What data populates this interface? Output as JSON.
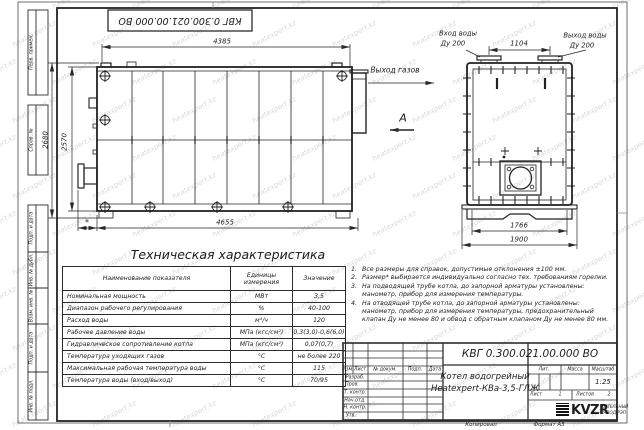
{
  "watermark": "heatexpert.kz",
  "frame": {
    "top_doc_box": "КВГ 0.300.021.00.000 ВО",
    "side_labels": [
      "Перв. примен.",
      "Справ. №",
      "Подп. и дата",
      "Инв. № дубл.",
      "Взам. инв. №",
      "Подп. и дата",
      "Инв. № подл."
    ],
    "footer_copied": "Копировал",
    "footer_format": "Формат А3"
  },
  "side_view": {
    "dim_top": "4385",
    "dim_bottom": "4655",
    "dim_height_outer": "2680",
    "dim_height_inner": "2570",
    "dim_burner": "*",
    "gas_outlet": "Выход газов",
    "view_label": "А"
  },
  "top_view": {
    "inlet_line1": "Вход воды",
    "inlet_line2": "Ду 200",
    "outlet_line1": "Выход воды",
    "outlet_line2": "Ду 200",
    "dim_nozzles": "1104",
    "dim_inner": "1766",
    "dim_outer": "1900"
  },
  "spec": {
    "title": "Техническая характеристика",
    "headers": {
      "name": "Наименование показателя",
      "unit": "Единицы измерения",
      "value": "Значение"
    },
    "rows": [
      {
        "name": "Номинальная мощность",
        "unit": "МВт",
        "value": "3,5"
      },
      {
        "name": "Диапазон рабочего регулирования",
        "unit": "%",
        "value": "40-100"
      },
      {
        "name": "Расход воды",
        "unit": "м³/ч",
        "value": "120"
      },
      {
        "name": "Рабочее давление воды",
        "unit": "МПа (кгс/см²)",
        "value": "0,3(3,0)-0,6(6,0)"
      },
      {
        "name": "Гидравлическое сопротивление котла",
        "unit": "МПа (кгс/см²)",
        "value": "0,07(0,7)"
      },
      {
        "name": "Температура уходящих газов",
        "unit": "°С",
        "value": "не более 220"
      },
      {
        "name": "Максимальная рабочая температура воды",
        "unit": "°С",
        "value": "115"
      },
      {
        "name": "Температура воды (вход/выход)",
        "unit": "°С",
        "value": "70/95"
      }
    ]
  },
  "notes": [
    {
      "num": "1.",
      "text": "Все размеры для справок, допустимые отклонения ±100 мм."
    },
    {
      "num": "2.",
      "text": "Размер* выбирается индивидуально согласно тех. требованиям горелки."
    },
    {
      "num": "3.",
      "text": "На подводящей трубе котла, до запорной арматуры установлены: манометр, прибор для измерения температуры."
    },
    {
      "num": "4.",
      "text": "На отводящей трубе котла, до запорной арматуры установлены: манометр, прибор для измерения температуры, предохранительный клапан Ду не менее 80 и обвод с обратным клапаном Ду не менее 80 мм."
    }
  ],
  "title_block": {
    "doc_number": "КВГ 0.300.021.00.000 ВО",
    "product_line1": "Котел водогрейный",
    "product_line2": "Heatexpert-КВа-3,5-ГЛЖ",
    "col_izm": "Изм.",
    "col_list": "Лист",
    "col_doc": "№ докум.",
    "col_podp": "Подп.",
    "col_data": "Дата",
    "rows": [
      "Разраб.",
      "Пров.",
      "Т. контр.",
      "Нач.отд.",
      "Н. контр.",
      "Утв."
    ],
    "lit": "Лит.",
    "mass": "Масса",
    "scale_label": "Масштаб",
    "scale": "1:25",
    "sheet_label": "Лист",
    "sheet": "1",
    "sheets_label": "Листов",
    "sheets": "2",
    "logo_text": "KVZR",
    "logo_sub1": "КОТЕЛЬНЫЙ",
    "logo_sub2": "ЗАВОД РЭП"
  }
}
